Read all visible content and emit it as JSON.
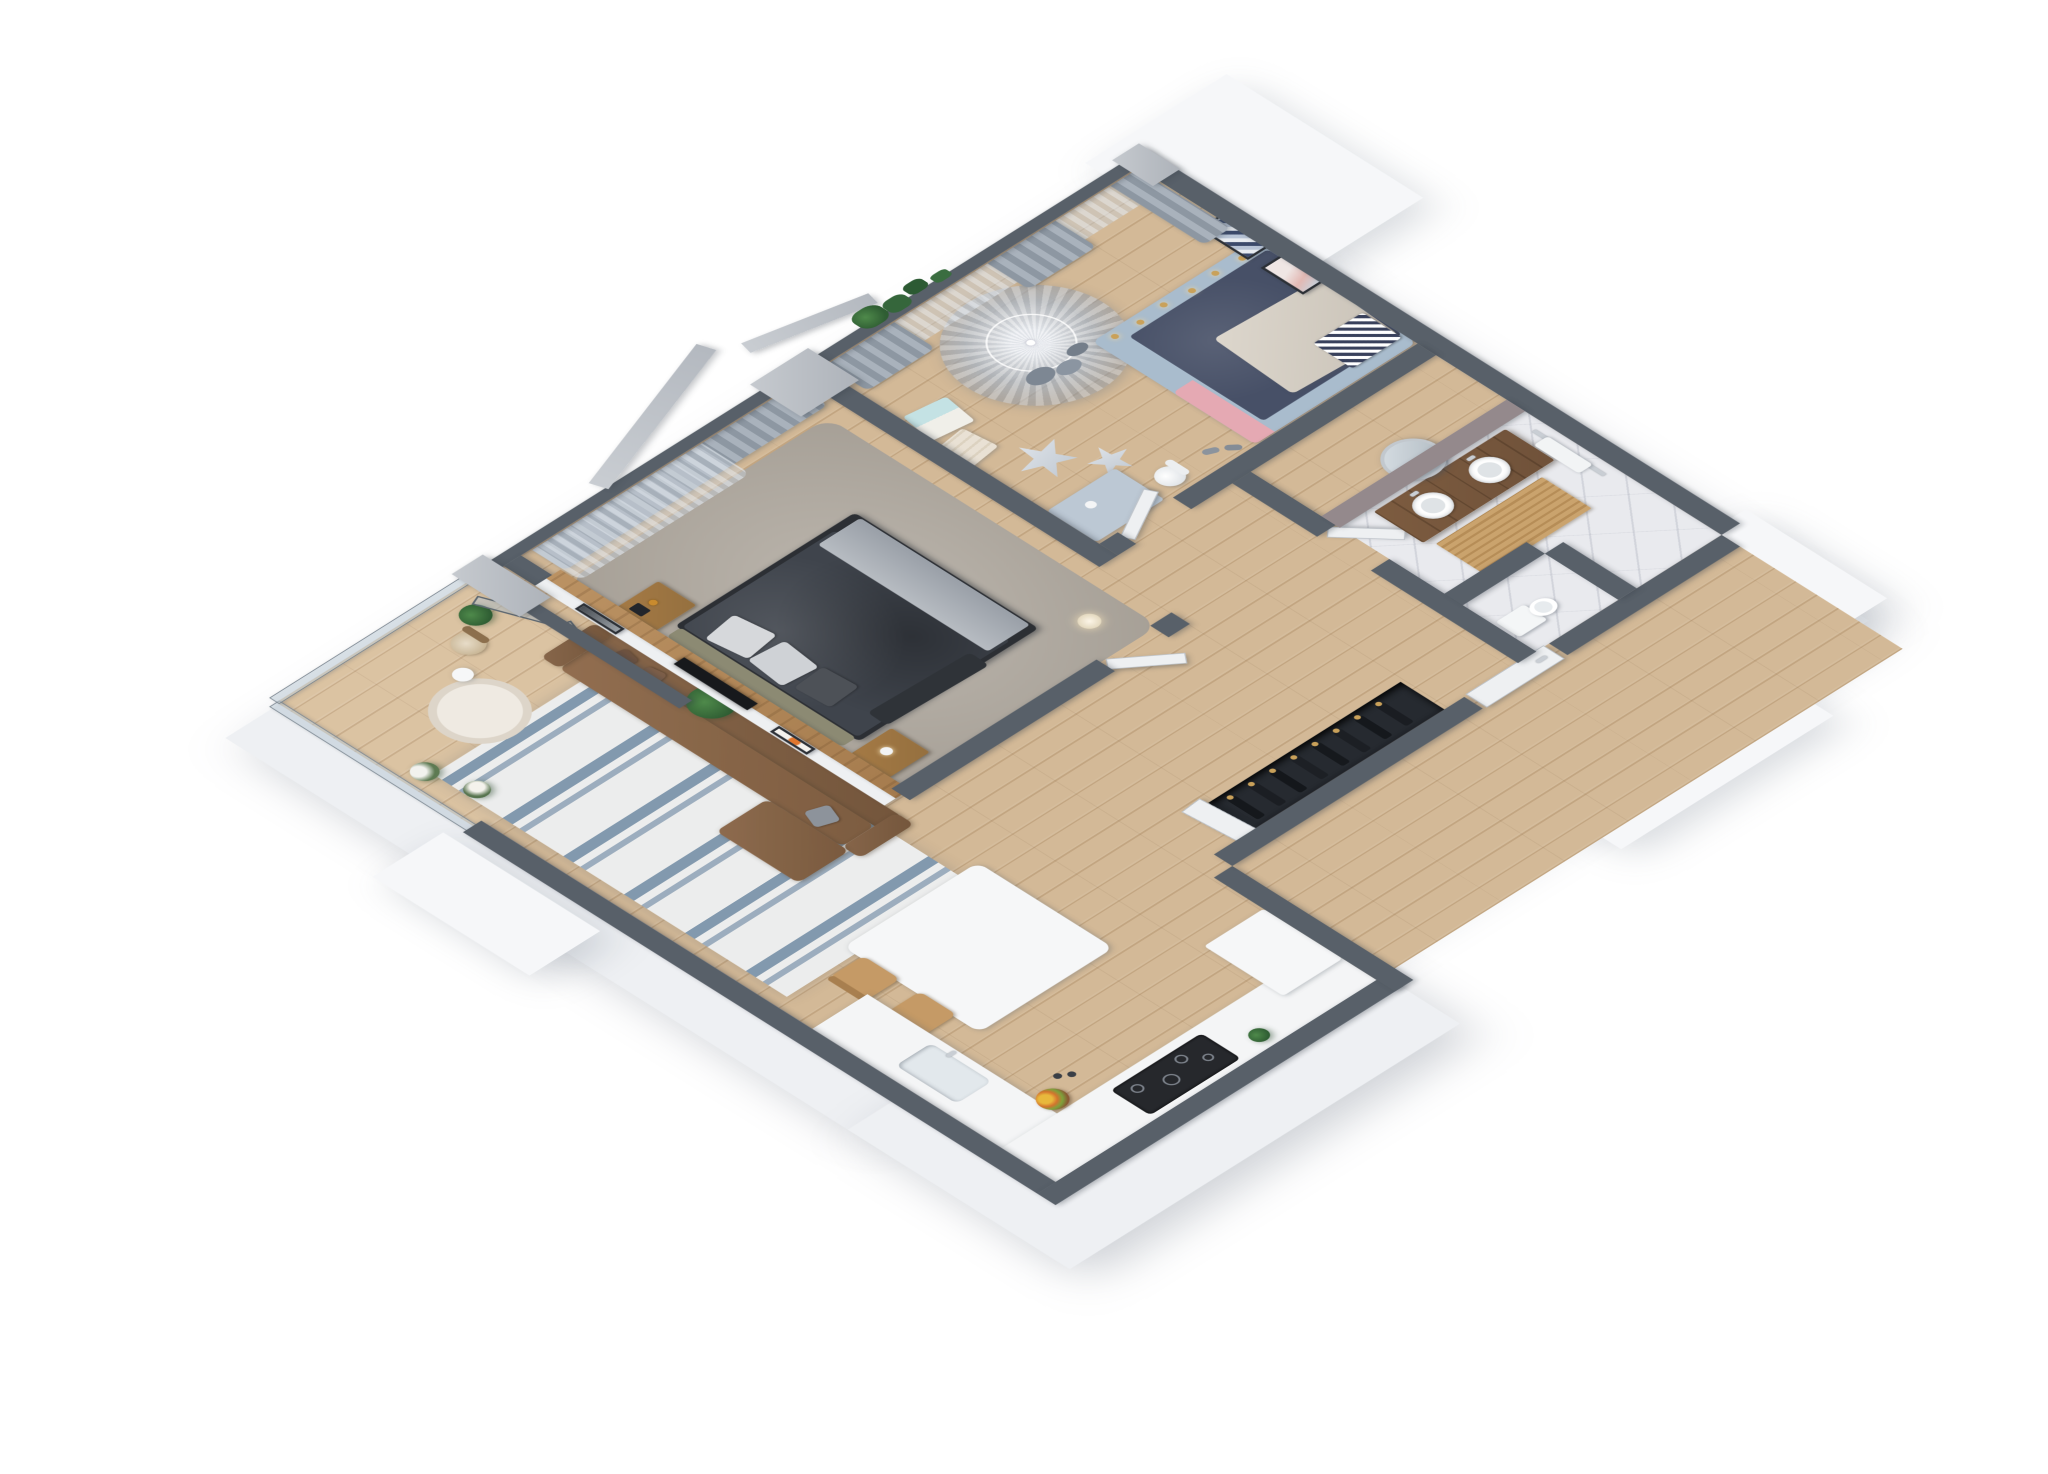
{
  "scene": {
    "type": "isometric-3d-floor-plan-render",
    "view": "cutaway walls, bird's-eye isometric, white background, no text labels",
    "rooms": [
      {
        "name": "balcony",
        "features": [
          "glass-balustrade",
          "folding-glass-doors",
          "round-rug",
          "rattan-chair",
          "potted-plants",
          "flower-boxes"
        ]
      },
      {
        "name": "living-room",
        "features": [
          "brown-corner-sofa",
          "striped-blue-white-rug",
          "potted-plant",
          "white-partition-with-two-framed-pictures"
        ]
      },
      {
        "name": "dining-area",
        "features": [
          "white-table",
          "two-wooden-chairs"
        ]
      },
      {
        "name": "kitchen",
        "features": [
          "white-l-counter",
          "sink-with-faucet",
          "black-induction-cooktop",
          "fruit-bowl",
          "white-tall-cabinet",
          "small-plant"
        ]
      },
      {
        "name": "master-bedroom",
        "features": [
          "dark-gray-double-bed",
          "olive-headboard",
          "two-wood-nightstands",
          "wall-tv-on-wood-partition",
          "gray-rug",
          "floor-lamp",
          "gray-curtains"
        ]
      },
      {
        "name": "kids-room",
        "features": [
          "canopy-tent",
          "star-pillows",
          "gift-boxes",
          "kids-bed-navy-mattress-pink-accents",
          "fairy-lights",
          "desk-with-white-chair",
          "slippers",
          "two-wall-art-frames",
          "sheer-and-gray-curtains",
          "blue-walls"
        ]
      },
      {
        "name": "hallway",
        "features": [
          "open-wardrobe-with-hanging-coats",
          "entry-door-with-silver-handle",
          "open-interior-doors"
        ]
      },
      {
        "name": "bathroom",
        "features": [
          "wood-vanity-two-vessel-sinks",
          "round-mirror",
          "wood-slat-mat",
          "towel-rail",
          "marble-floor"
        ]
      },
      {
        "name": "wc",
        "features": [
          "toilet"
        ]
      }
    ],
    "structure": [
      "thick-cut-walls-dark-gray-tops",
      "white-exterior-wall-sides",
      "concrete-pillars-with-angled-beams",
      "entry-porch-blocks",
      "roof-planter-greenery"
    ]
  },
  "colors": {
    "background": "#ffffff",
    "wall_top": "#586069",
    "exterior_side": "#eef0f3",
    "floor_wood": "#d3b997",
    "floor_wood_dark": "#c2a581",
    "marble": "#e9eaee",
    "bath_wall": "#94898c",
    "rug_base": "#eceded",
    "rug_stripe_blue": "#8299ae",
    "master_rug": "#b3aca2",
    "sofa": "#87664a",
    "sofa_dark": "#74563c",
    "wood_partition": "#b28455",
    "bed_duvet": "#3f444c",
    "bed_sheet": "#aab0b7",
    "headboard": "#8c8a73",
    "nightstand": "#95703f",
    "kids_bed_frame": "#a9bccd",
    "kids_mattress": "#475067",
    "kids_pink": "#e5a9b3",
    "canopy": "#aeb8c4",
    "curtain_gray": "#8d97a2",
    "curtain_sheer": "#d3dae2",
    "glass": "#bccad5",
    "vanity_wood": "#70523a",
    "plant": "#2f5d33",
    "gold": "#c9a15a",
    "tv_black": "#17191c",
    "cooktop": "#26282c",
    "counter": "#f4f5f6",
    "door_white": "#eef0f2",
    "chair_wood": "#c59a66"
  }
}
